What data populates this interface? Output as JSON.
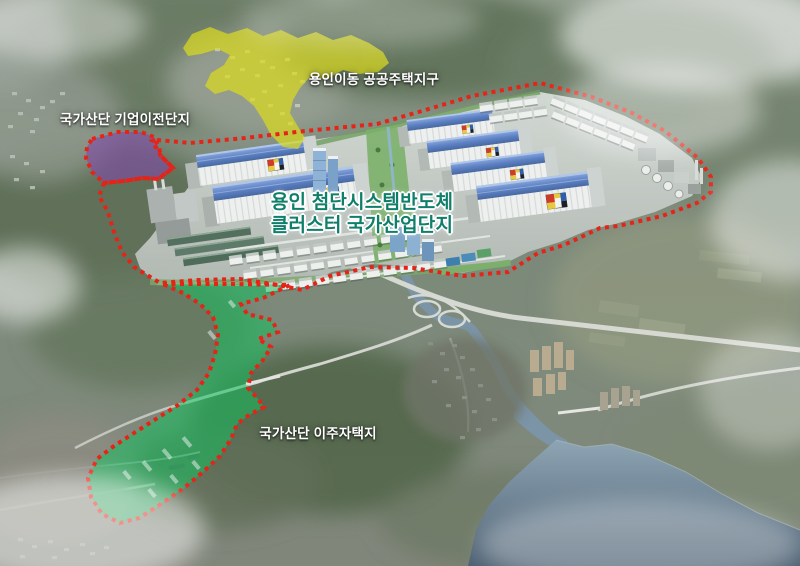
{
  "scene": {
    "labels": {
      "housing_district": "용인이동 공공주택지구",
      "relocation_complex": "국가산단 기업이전단지",
      "cluster_title_line1": "용인 첨단시스템반도체",
      "cluster_title_line2": "클러스터 국가산업단지",
      "resettlement_housing": "국가산단 이주자택지"
    },
    "colors": {
      "zone_yellow": "#d9da1e",
      "zone_purple": "#8149a8",
      "zone_green": "#14c05e",
      "boundary_red": "#e62317",
      "cluster_label_teal": "#0f7f6a",
      "label_white": "#ffffff"
    }
  }
}
